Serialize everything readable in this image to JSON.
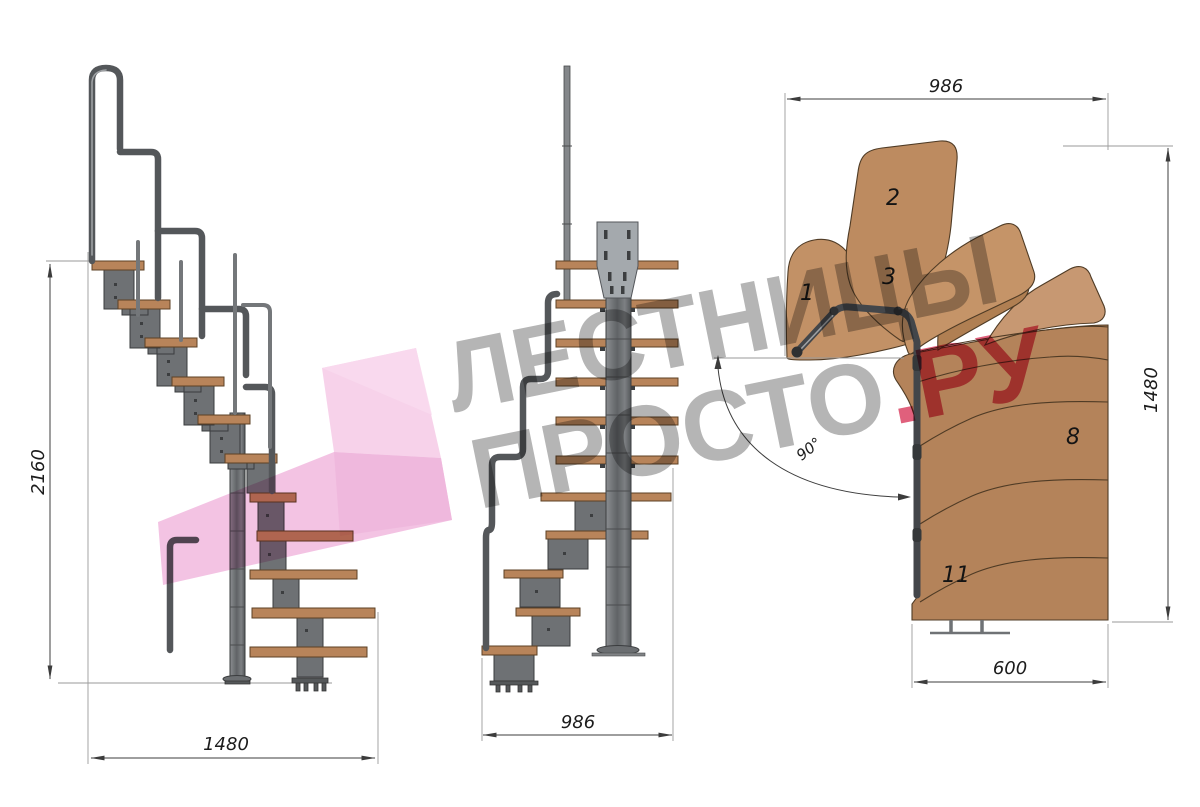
{
  "drawing": {
    "type": "staircase-technical-drawing",
    "views": [
      "side-elevation",
      "front-elevation",
      "top-plan"
    ]
  },
  "watermark": {
    "line1": "ЛЕСТНИЦЫ",
    "line2": "ПРОСТО",
    "line2_suffix": ".РУ",
    "gray_color": "#b5b5b5",
    "red_color": "#e0607c",
    "pink_color": "#f3c0e2"
  },
  "side_view": {
    "height_dim": "2160",
    "length_dim": "1480"
  },
  "front_view": {
    "width_dim": "986"
  },
  "plan_view": {
    "width_dim": "986",
    "depth_dim": "1480",
    "flight_width_dim": "600",
    "turn_angle": "90°",
    "step_numbers": [
      "1",
      "2",
      "3",
      "8",
      "11"
    ]
  },
  "colors": {
    "wood": "#b8845a",
    "wood_plan": "#bd8b60",
    "metal": "#6e7174",
    "dimension_line": "#3c3c3c"
  }
}
